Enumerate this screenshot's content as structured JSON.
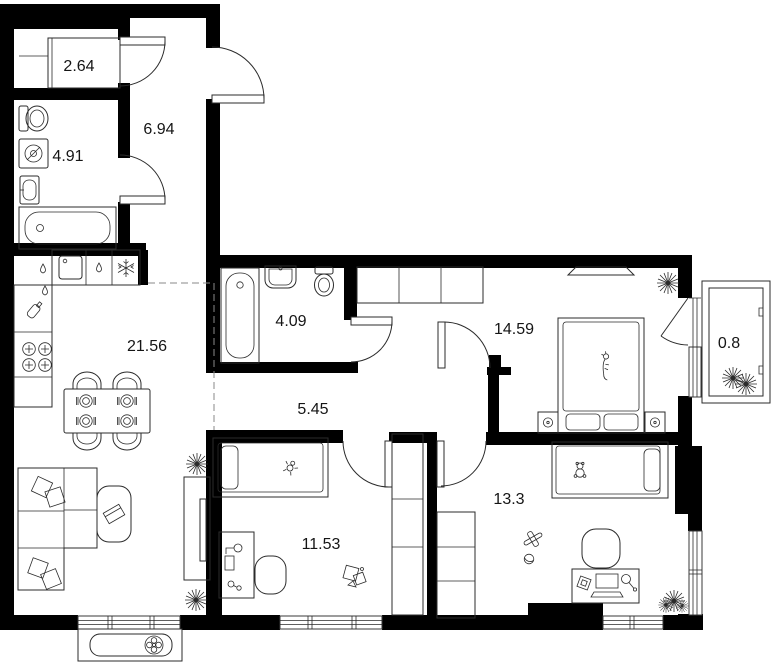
{
  "title": "Apartment floor plan",
  "rooms": {
    "storage": {
      "name": "storage",
      "area": "2.64"
    },
    "hallway": {
      "name": "entrance hall",
      "area": "6.94"
    },
    "bathroom_small": {
      "name": "bathroom",
      "area": "4.91"
    },
    "kitchen_living": {
      "name": "kitchen-living",
      "area": "21.56"
    },
    "bathroom": {
      "name": "bathroom",
      "area": "4.09"
    },
    "corridor": {
      "name": "corridor",
      "area": "5.45"
    },
    "bedroom": {
      "name": "bedroom",
      "area": "14.59"
    },
    "balcony": {
      "name": "balcony",
      "area": "0.8"
    },
    "kids_room_1": {
      "name": "child room",
      "area": "11.53"
    },
    "kids_room_2": {
      "name": "child room",
      "area": "13.3"
    }
  },
  "icons": {
    "plant": "starburst plant",
    "snowflake": "fridge-freezer snowflake",
    "drop": "water drop / dishwasher",
    "burner": "stove burner",
    "fan": "outdoor a/c fan unit",
    "plate": "table place setting",
    "cat": "cat on bed",
    "teddy": "teddy bear toy",
    "plane": "toy plane"
  },
  "colors": {
    "wall": "#000000",
    "furniture_line": "#2b2b2b",
    "label": "#151515",
    "dashed_zone": "#8a8a8a",
    "background": "#ffffff"
  }
}
